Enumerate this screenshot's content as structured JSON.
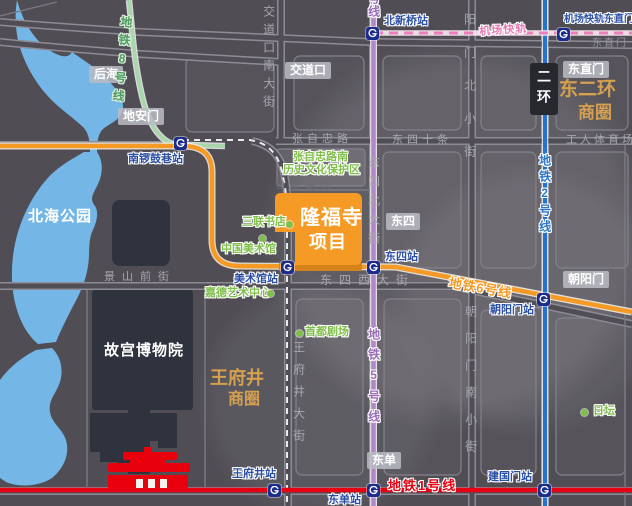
{
  "project": {
    "name_line1": "隆福寺",
    "name_line2": "项目"
  },
  "districts": {
    "dong_erhuan_line1": "东二环",
    "dong_erhuan_line2": "商圈",
    "wangfujing_line1": "王府井",
    "wangfujing_line2": "商圈"
  },
  "places": {
    "beihai_park": "北海公园",
    "palace_museum": "故宫博物院"
  },
  "heritage_zone": {
    "line1": "张自忠路南",
    "line2": "历史文化保护区"
  },
  "badges": {
    "houhai": "后海",
    "dianmen": "地安门",
    "jiaodaokou": "交道口",
    "dongsi": "东四",
    "dongdan": "东单",
    "chaoyangmen": "朝阳门",
    "dongzhimen": "东直门",
    "erhuan": "二环"
  },
  "stations": {
    "nanluoguxiang": "南锣鼓巷站",
    "beixinqiao": "北新桥站",
    "airport_dongzhimen": "机场快轨东直门站",
    "meishuguan": "美术馆站",
    "dongsi": "东四站",
    "chaoyangmen": "朝阳门站",
    "wangfujing": "王府井站",
    "dongdan": "东单站",
    "jianguomen": "建国门站"
  },
  "metro_lines": {
    "line1": "地铁1号线",
    "line2": "地铁2号线",
    "line5": "地铁5号线",
    "line5_top_partial": "号线",
    "line6": "地铁6号线",
    "line8": "地铁8号线",
    "airport_express": "机场快轨"
  },
  "streets": {
    "jiaodaokou_nandajie": "交道口南大街",
    "zhangzizhong_lu": "张自忠路",
    "dongsi_shitiao": "东四十条",
    "gongren_tiyuchang": "工人体育场",
    "dongzhimen": "东直门",
    "dongsi_beidajie": "东四北大街",
    "yangmen_beixiaojie": "阳门北小街",
    "chaoyangmen_nanxiaojie": "朝阳门南小街",
    "dongsi_xidajie": "东四西大街",
    "jingshan_qianjie": "景山前街",
    "wangfujing_dajie": "王府井大街",
    "qianliang_hutong": "钱粮胡同"
  },
  "pois": {
    "sanlian_bookstore": "三联书店",
    "china_art_museum": "中国美术馆",
    "guardian_art_center": "嘉德艺术中心",
    "capital_theatre": "首都剧场",
    "ritan": "日坛"
  },
  "icons": {
    "station_marker": "beijing-subway-logo",
    "poi_marker": "green-dot"
  },
  "colors": {
    "background": "#504d55",
    "water": "#74b7e6",
    "palace_block": "#2e333e",
    "project_orange": "#f59b25",
    "project_orange_dark": "#d4821c",
    "line1_red": "#e60012",
    "line2_blue": "#2274d0",
    "line5_purple": "#b287c9",
    "line6_orange": "#f59b25",
    "line8_green": "#a9d6ab",
    "airport_pink": "#ed7fbd",
    "station_text_blue": "#2b4fa5",
    "poi_green": "#7fbf4a",
    "district_gold": "#d5a04f",
    "street_gray": "#a8a6ad",
    "tiananmen_red": "#e8000d"
  }
}
